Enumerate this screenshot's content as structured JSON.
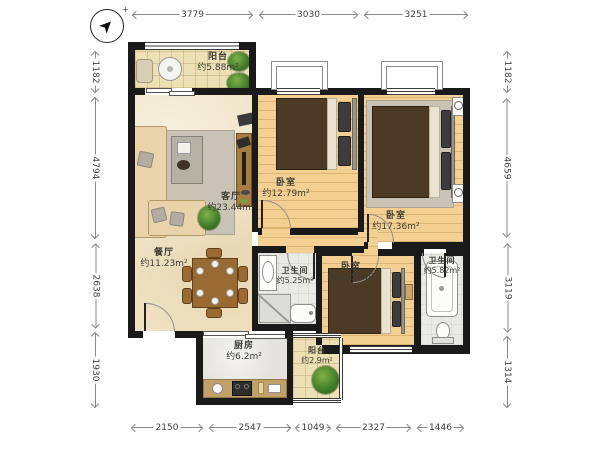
{
  "compass": {
    "mark": "➤",
    "plus": "+"
  },
  "dimensions": {
    "top": [
      "3779",
      "3030",
      "3251"
    ],
    "bottom": [
      "2150",
      "2547",
      "1049",
      "2327",
      "1446"
    ],
    "left": [
      "1182",
      "4794",
      "2638",
      "1930"
    ],
    "right": [
      "1182",
      "4659",
      "3119",
      "1314"
    ]
  },
  "rooms": {
    "balcony_top": {
      "name": "阳台",
      "area": "约5.88m²"
    },
    "living": {
      "name": "客厅",
      "area": "约23.44m²"
    },
    "dining": {
      "name": "餐厅",
      "area": "约11.23m²"
    },
    "kitchen": {
      "name": "厨房",
      "area": "约6.2m²"
    },
    "balcony_bottom": {
      "name": "阳台",
      "area": "约2.9m²"
    },
    "bedroom_mid": {
      "name": "卧室",
      "area": "约12.79m²"
    },
    "bedroom_right": {
      "name": "卧室",
      "area": "约17.36m²"
    },
    "bedroom_bottom": {
      "name": "卧室",
      "area": "约10.51m²"
    },
    "bath_mid": {
      "name": "卫生间",
      "area": "约5.25m²"
    },
    "bath_right": {
      "name": "卫生间",
      "area": "约5.82m²"
    }
  },
  "colors": {
    "wall": "#1a1a1a",
    "wood_floor": "#f3d092",
    "tile_floor": "#ece0b4",
    "plant_green": "#3f7a27"
  }
}
